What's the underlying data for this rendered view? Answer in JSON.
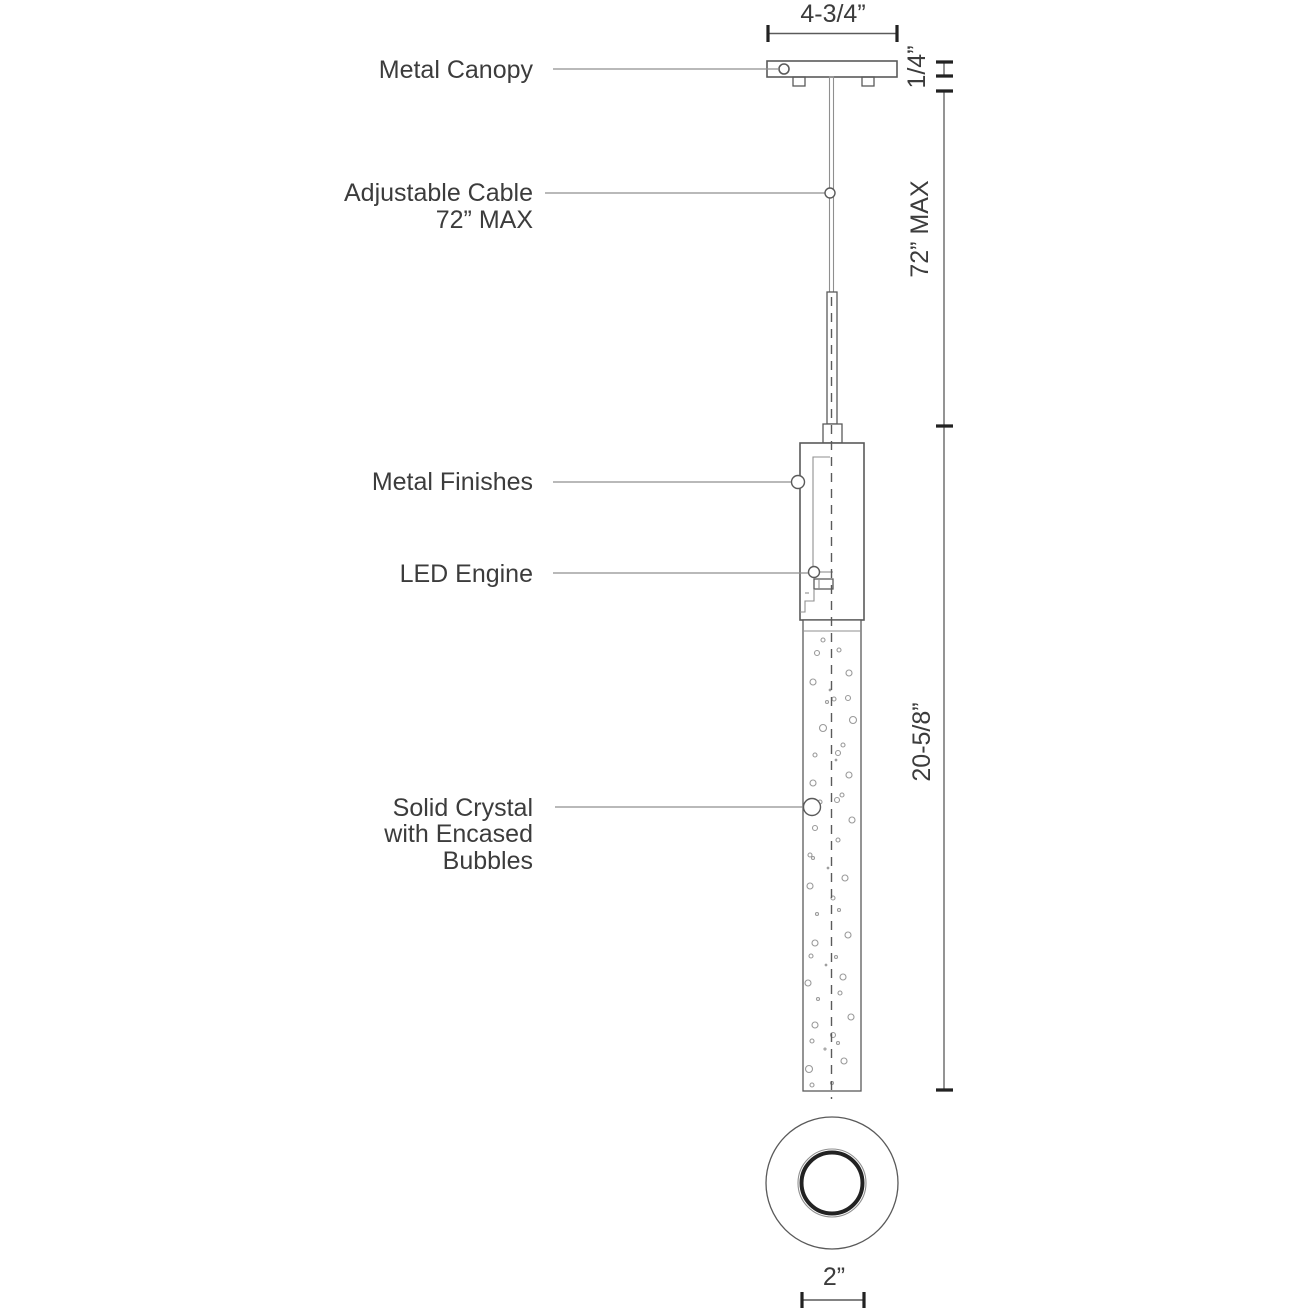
{
  "figure": {
    "type": "technical-line-drawing",
    "subject": "LED pendant light fixture, side elevation with bottom view"
  },
  "labels": {
    "metal_canopy": "Metal Canopy",
    "adjustable_cable_line1": "Adjustable Cable",
    "adjustable_cable_line2": "72” MAX",
    "metal_finishes": "Metal Finishes",
    "led_engine": "LED Engine",
    "solid_crystal_line1": "Solid Crystal",
    "solid_crystal_line2": "with Encased",
    "solid_crystal_line3": "Bubbles"
  },
  "dimensions": {
    "canopy_width": "4-3/4”",
    "canopy_thickness": "1/4”",
    "max_drop": "72” MAX",
    "fixture_height": "20-5/8”",
    "diffuser_diameter": "2”"
  },
  "colors": {
    "background": "#ffffff",
    "drawing_line": "#5a5a5a",
    "leader_line": "#8f8f8f",
    "text": "#3c3c3c",
    "tick": "#222222",
    "bubble": "#9a9a9a"
  },
  "drawing": {
    "bubbles": [
      [
        823,
        640,
        2
      ],
      [
        817,
        653,
        2.5
      ],
      [
        839,
        650,
        2
      ],
      [
        849,
        673,
        3
      ],
      [
        813,
        682,
        3
      ],
      [
        830,
        690,
        0.8
      ],
      [
        848,
        698,
        2.5
      ],
      [
        834,
        699,
        2
      ],
      [
        827,
        702,
        1.5
      ],
      [
        853,
        720,
        3.5
      ],
      [
        823,
        728,
        3.5
      ],
      [
        843,
        745,
        2
      ],
      [
        838,
        753,
        2.5
      ],
      [
        815,
        755,
        2
      ],
      [
        836,
        760,
        0.8
      ],
      [
        849,
        775,
        3
      ],
      [
        813,
        783,
        3
      ],
      [
        842,
        795,
        2
      ],
      [
        837,
        800,
        2.5
      ],
      [
        820,
        802,
        2
      ],
      [
        852,
        820,
        3
      ],
      [
        815,
        828,
        2.5
      ],
      [
        838,
        840,
        2
      ],
      [
        810,
        855,
        2
      ],
      [
        813,
        858,
        1.5
      ],
      [
        828,
        868,
        0.8
      ],
      [
        845,
        878,
        3
      ],
      [
        810,
        886,
        3
      ],
      [
        833,
        898,
        2
      ],
      [
        839,
        910,
        1.5
      ],
      [
        817,
        914,
        1.5
      ],
      [
        848,
        935,
        3
      ],
      [
        815,
        943,
        3
      ],
      [
        811,
        956,
        2
      ],
      [
        836,
        957,
        1.5
      ],
      [
        826,
        965,
        0.8
      ],
      [
        843,
        977,
        3
      ],
      [
        808,
        983,
        3
      ],
      [
        840,
        993,
        2
      ],
      [
        818,
        999,
        1.5
      ],
      [
        851,
        1017,
        3
      ],
      [
        815,
        1025,
        3
      ],
      [
        833,
        1035,
        2.5
      ],
      [
        812,
        1041,
        2
      ],
      [
        838,
        1043,
        1.5
      ],
      [
        825,
        1049,
        1
      ],
      [
        844,
        1061,
        3
      ],
      [
        809,
        1069,
        3.5
      ],
      [
        832,
        1083,
        1.5
      ],
      [
        812,
        1085,
        2
      ]
    ]
  }
}
